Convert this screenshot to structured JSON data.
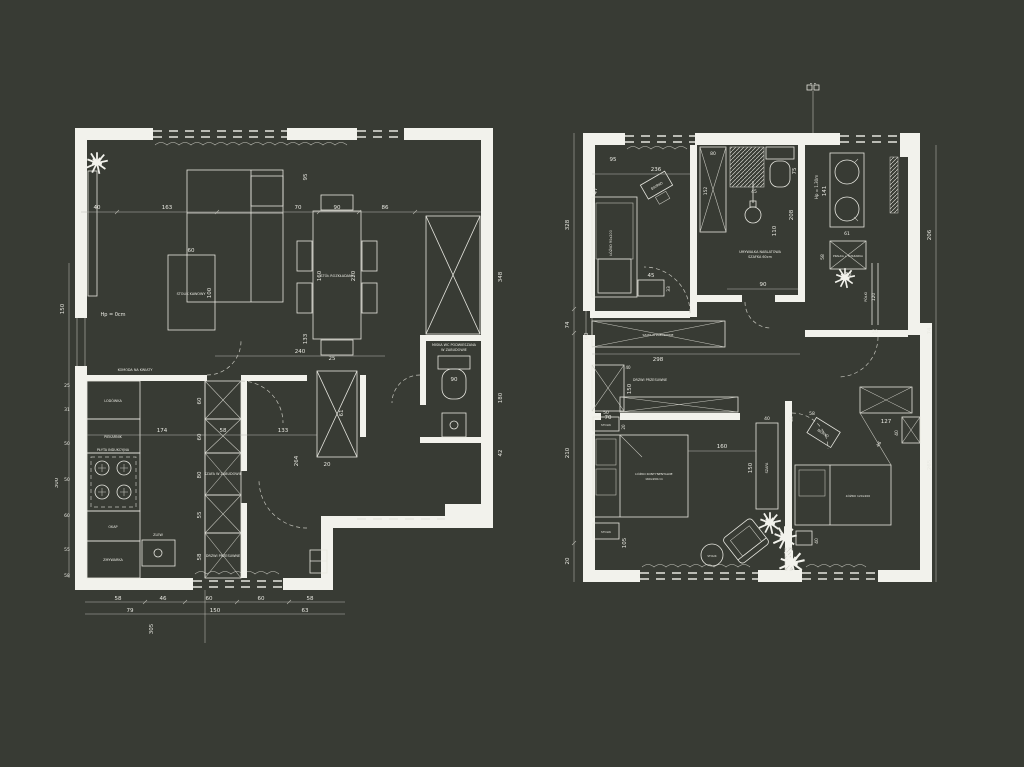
{
  "canvas": {
    "background": "#383b34",
    "ink": "#f2f2ec"
  },
  "left": {
    "labels": {
      "hp": "Hp = 0cm",
      "coffee": "STOLIK KAWOWY",
      "table": "STÓŁ ROZKŁADANY",
      "komoda": "KOMODA NA KWIATY",
      "wc1": "MISKA WC PODWIESZANA",
      "wc2": "W ZABUDOWIE",
      "szafa1": "SZAFA W ZABUDOWIE",
      "szafa2": "DRZWI PRZESUWNE",
      "lodowka": "LODÓWKA",
      "piekarnik": "PIEKARNIK",
      "plyta": "PŁYTA INDUKCYJNA",
      "zlew": "ZLEW",
      "zmywarka": "ZMYWARKA",
      "okap": "OKAP"
    },
    "dims": {
      "top40": "40",
      "top163": "163",
      "top70": "70",
      "top90": "90",
      "top86": "86",
      "t95": "95",
      "ct60": "60",
      "ct100": "100",
      "tbl160": "160",
      "tbl220": "220",
      "tbl133": "133",
      "hall240": "240",
      "hall25": "25",
      "w348": "348",
      "wc90": "90",
      "wc180": "180",
      "wc42": "42",
      "k174": "174",
      "k58": "58",
      "k133": "133",
      "k264": "264",
      "hx61": "61",
      "hx20": "20",
      "col60a": "60",
      "col60b": "60",
      "col80": "80",
      "col55": "55",
      "col58": "58",
      "lf150": "150",
      "lf25": "25",
      "lf31": "31",
      "lf50a": "50",
      "lf50b": "50",
      "lf60": "60",
      "lf55": "55",
      "lf58": "58",
      "lf300": "300",
      "b58a": "58",
      "b46": "46",
      "b60a": "60",
      "b60b": "60",
      "b58b": "58",
      "b79": "79",
      "b150": "150",
      "b63": "63",
      "b305": "305"
    }
  },
  "right": {
    "labels": {
      "marker": "B B",
      "hp130": "Hp = 1.30m",
      "kidbed": "ŁÓŻKO 90x200",
      "biurko": "BIURKO",
      "szafa1": "SZAFA W ZABUDOWIE",
      "szafa2": "DRZWI PRZESUWNE",
      "sink1": "UMYWALKA NABLATOWA",
      "sink2": "SZAFKA 60cm",
      "pralka": "PRALKA + SUSZARKA",
      "masterbed1": "ŁÓŻKO KONTYNENTALNE",
      "masterbed2": "160x200cm",
      "stolik": "STOLIK",
      "szafa": "SZAFA",
      "bed2": "ŁÓŻKO 120x200",
      "polki": "PÓŁKI"
    },
    "dims": {
      "k95": "95",
      "k236": "236",
      "k47": "47",
      "k45": "45",
      "k33": "33",
      "w80": "80",
      "w152": "152",
      "t75": "75",
      "s45": "45",
      "s110": "110",
      "s90": "90",
      "s208": "208",
      "u141": "141",
      "u61": "61",
      "u58": "58",
      "u70": "70",
      "sh120": "120",
      "sh20": "20",
      "c60": "60",
      "c298": "298",
      "c70": "70",
      "c150": "150",
      "c40": "40",
      "c50": "50",
      "c20": "20",
      "m160": "160",
      "m150": "150",
      "m40": "40",
      "m105": "105",
      "b127": "127",
      "b40": "40",
      "b46": "46",
      "b50": "50",
      "b58": "58",
      "b2_40": "40",
      "l328": "328",
      "l74": "74",
      "l210": "210",
      "l20": "20",
      "r206": "206",
      "r74": "74",
      "r265": "265"
    }
  }
}
